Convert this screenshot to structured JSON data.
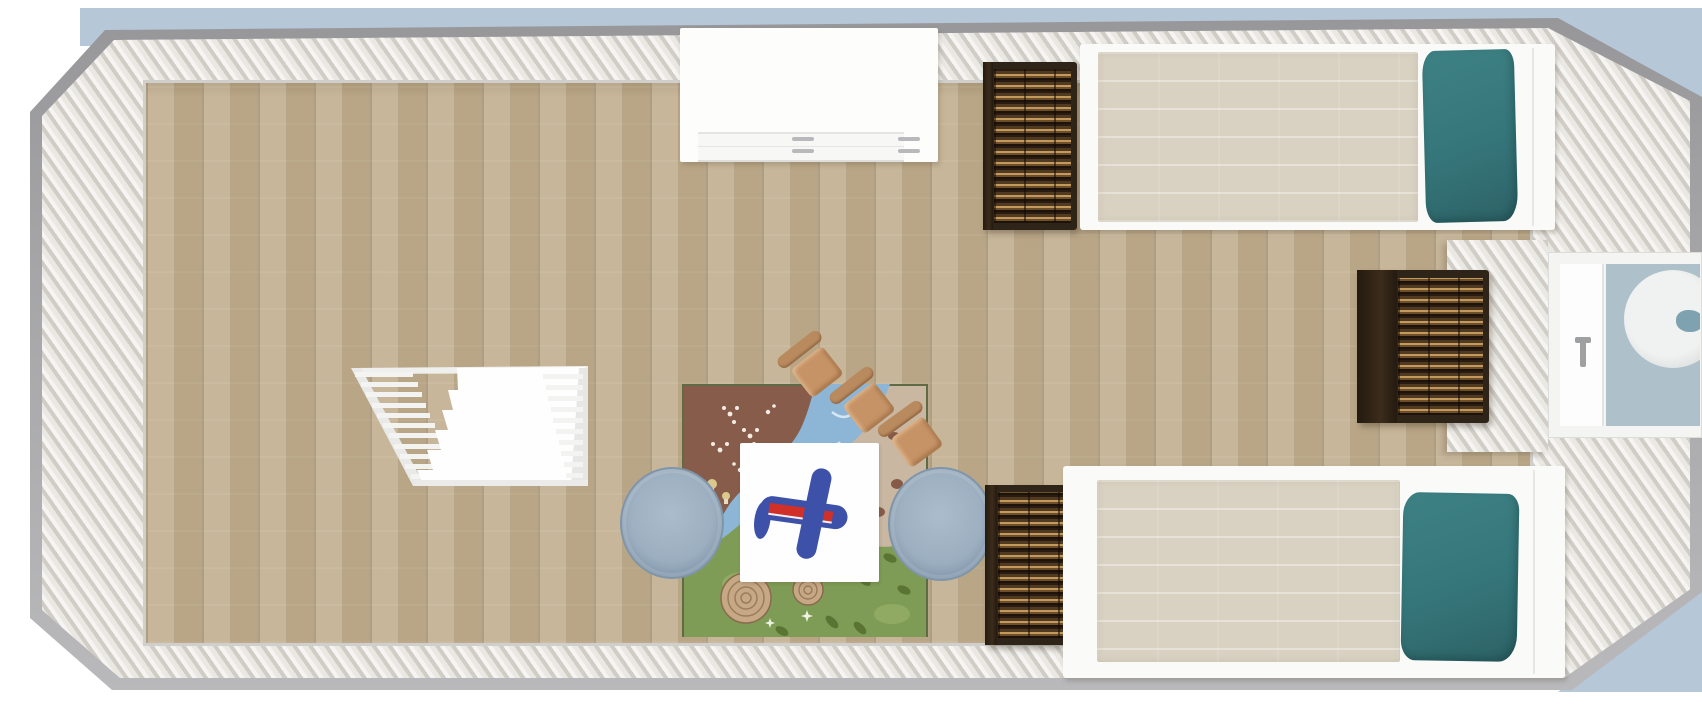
{
  "scene": {
    "title": "Kids bedroom floor plan, top-down 3D render",
    "room": {
      "walls": "cream ribbed walls with beveled corners",
      "floor": "light oak vertical planks",
      "backdrop": "pale blue exterior visible at top and corners"
    },
    "colors": {
      "backdrop": "#ffffff",
      "sky": "#b6c7d8",
      "wall-outer": "#a3a3a5",
      "wall-face": "#eae8e3",
      "wall-stripe": "#d2cfc9",
      "floor": "#c1ae8e",
      "floor-seam": "#8f7352",
      "bed-frame": "#fafaf9",
      "duvet": "#d9d2c2",
      "pillow": "#35767a",
      "wicker-dark": "#34281b",
      "wicker-mid": "#7a5a34",
      "wicker-light": "#c49a5c",
      "stool": "#9cafc0",
      "table": "#fefefe",
      "plane-blue": "#3d51a8",
      "plane-red": "#d03028",
      "chair": "#c69366",
      "rug-tan": "#c9b7a2",
      "rug-brown": "#875c4a",
      "rug-river": "#8db6d6",
      "rug-green": "#7e9c55",
      "rug-border": "#5e6b45",
      "crib": "#f2f2f1",
      "window-glass": "#aec0ca"
    },
    "furniture": [
      {
        "id": "dresser-white",
        "label": "white dresser with drawers, top wall"
      },
      {
        "id": "wicker-top",
        "label": "dark wicker chest beside top bed"
      },
      {
        "id": "bed-top",
        "label": "twin bed with cream duvet and teal pillow, top right"
      },
      {
        "id": "wicker-middle",
        "label": "dark wicker chest against right wall"
      },
      {
        "id": "window",
        "label": "window in right wall with round pool outside"
      },
      {
        "id": "crib",
        "label": "white slatted crib, angled on left floor"
      },
      {
        "id": "play-rug",
        "label": "nature play rug with river, grass and stumps"
      },
      {
        "id": "kid-chair-1",
        "label": "small wooden chair 1"
      },
      {
        "id": "kid-chair-2",
        "label": "small wooden chair 2"
      },
      {
        "id": "kid-chair-3",
        "label": "small wooden chair 3"
      },
      {
        "id": "play-table",
        "label": "white square play table"
      },
      {
        "id": "toy-airplane",
        "label": "blue and red toy airplane on table"
      },
      {
        "id": "stool-left",
        "label": "round blue-grey pouf left of table"
      },
      {
        "id": "stool-right",
        "label": "round blue-grey pouf right of table"
      },
      {
        "id": "wicker-bottom",
        "label": "dark wicker chest beside bottom bed"
      },
      {
        "id": "bed-bottom",
        "label": "twin bed with cream duvet and teal pillow, bottom right"
      }
    ]
  }
}
